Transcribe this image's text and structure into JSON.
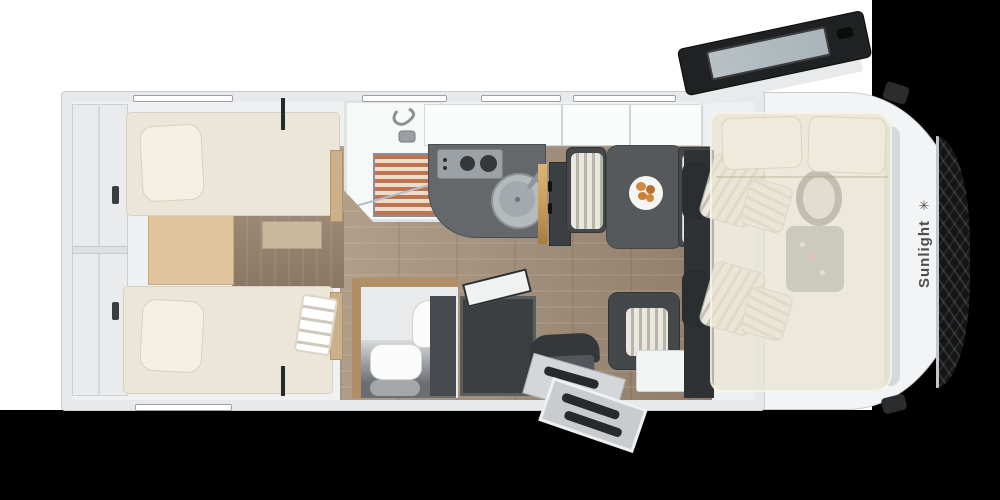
{
  "brand": {
    "name": "Sunlight",
    "logo_glyph": "✳",
    "logo_icon": "sun-icon"
  },
  "palette": {
    "bg": "#000000",
    "backdrop": "#ffffff",
    "shell": "#f3f4f5",
    "wall": "#e7e9eb",
    "wall_edge": "#c8cccf",
    "garage": "#e9ebec",
    "mattress": "#ebe6d8",
    "pillow": "#f4f0e3",
    "pillow_edge": "#d9d1bc",
    "oak": "#dfc49d",
    "step": "#c9b89e",
    "corridor": "#9d8a76",
    "floor_a": "#b3a08b",
    "floor_b": "#8f7c69",
    "counter": "#64686b",
    "hob": "#9ba1a5",
    "burner": "#35383a",
    "sink": "#b5babd",
    "sink_inner": "#a4a9ad",
    "gold": "#c79e5c",
    "dark": "#3c3f42",
    "table": "#56595c",
    "cushion_a": "#eae7dd",
    "cushion_b": "#b8b5ac",
    "slat": "#bd7450",
    "slat_bg": "#ecdccb",
    "wood_wall": "#b18f66",
    "wash_floor": "#e9eaeb",
    "counter_glass_a": "#d8dadc",
    "counter_glass_b": "#6b6e71",
    "white_goods": "#fbfbfb",
    "bed_glass": "rgba(233,227,209,0.72)",
    "pillow_cab": "#efeadc",
    "grille": "#141516",
    "grille_line": "rgba(255,255,255,0.12)",
    "brand": "#4d4d4d",
    "door_panel": "#d4d7d9",
    "tread": "#27292b",
    "step_metal": "#c9cccf",
    "glass": "#a9b4b9",
    "door_dark": "#1f2122",
    "plate": "#f5f5f3",
    "food": "#d08a3e",
    "cab_floor": "#2f3234",
    "seat_stripe_a": "#ece9de",
    "seat_stripe_b": "#c5c2b7",
    "windshield": "#d6d9db"
  },
  "floorplan": {
    "view": "motorhome-top-view",
    "areas": [
      "rear-garage-storage",
      "twin-single-beds",
      "shower-room",
      "kitchen-with-hob-and-sink",
      "washroom-with-basin-and-toilet",
      "wardrobe",
      "dinette-with-table",
      "entry-door-with-step",
      "cab-with-swivel-seats",
      "drop-down-bed-over-cab"
    ]
  }
}
